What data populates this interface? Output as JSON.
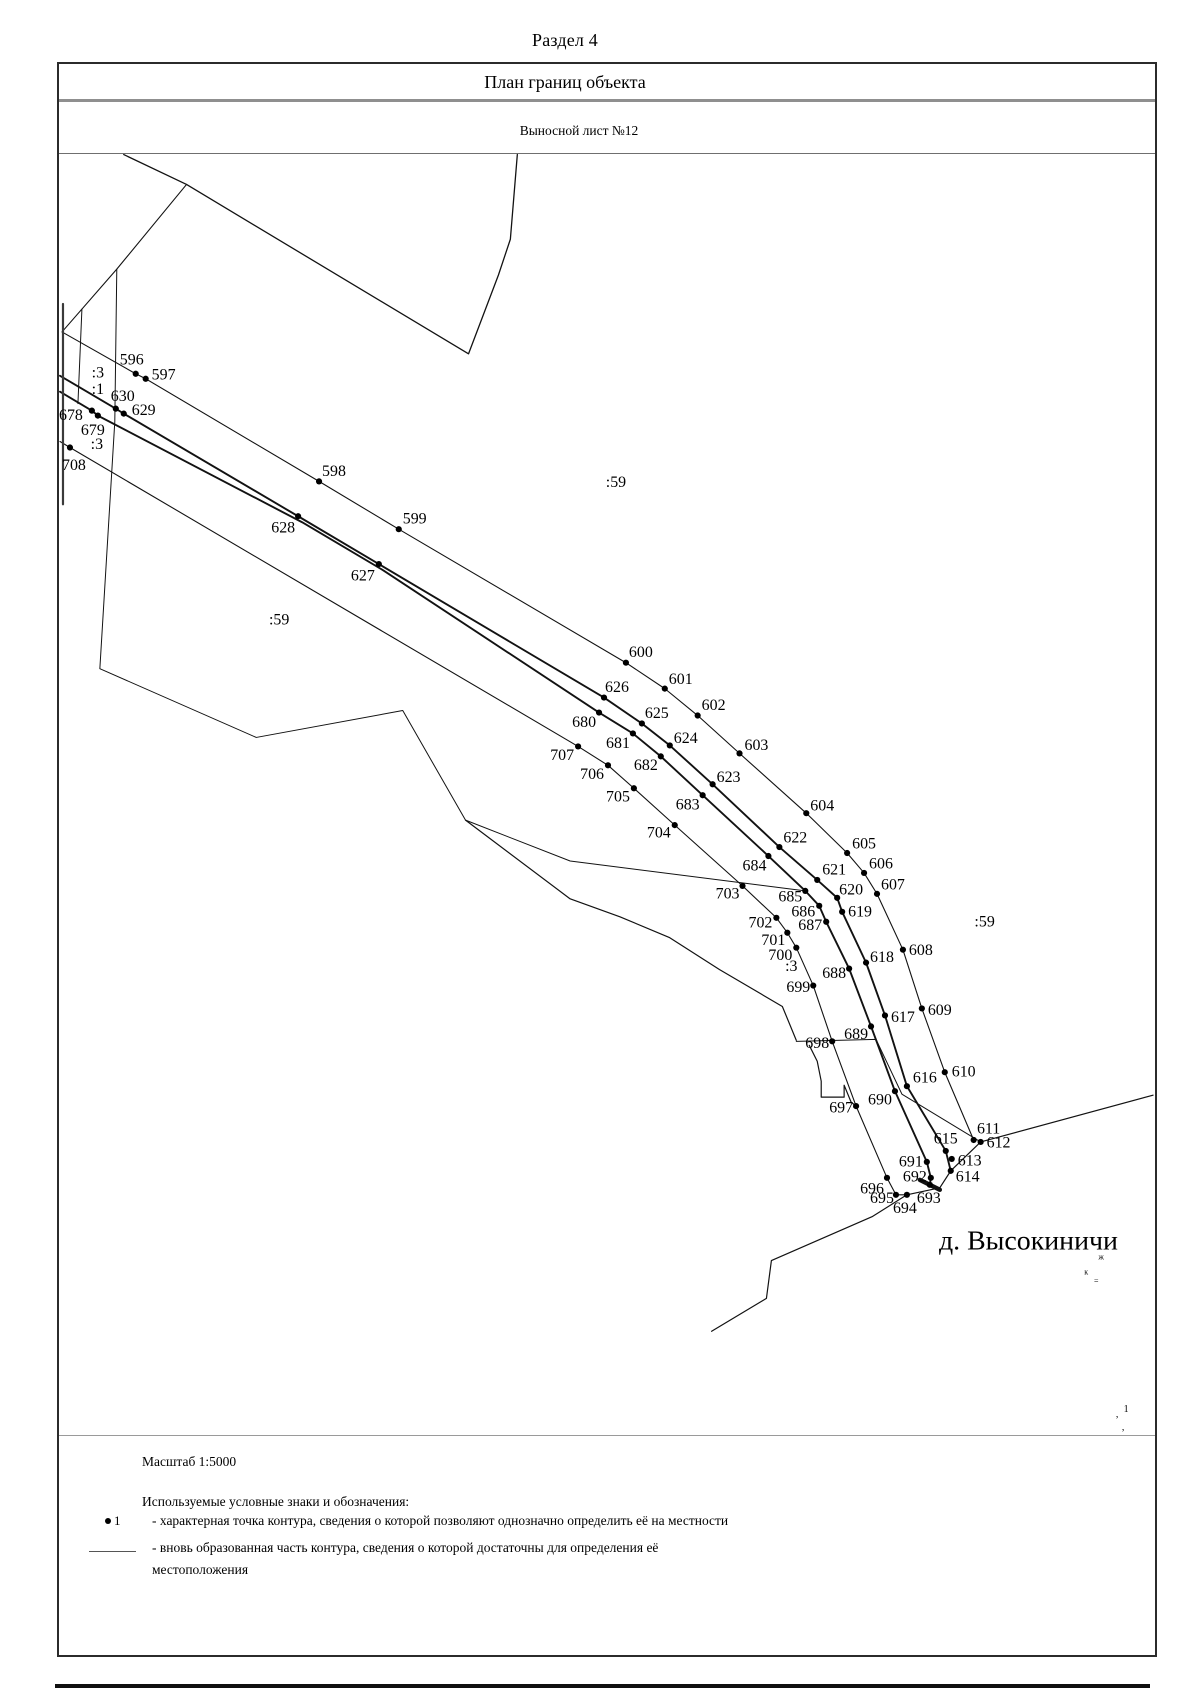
{
  "page": {
    "title": "Раздел 4"
  },
  "panel": {
    "header": "План границ объекта",
    "subheader": "Выносной лист №12"
  },
  "map": {
    "village_label": "д. Высокиничи",
    "parcel_labels": [
      {
        "text": ":3",
        "x": 96,
        "y": 370
      },
      {
        "text": ":1",
        "x": 96,
        "y": 387
      },
      {
        "text": ":3",
        "x": 95,
        "y": 442
      },
      {
        "text": ":59",
        "x": 616,
        "y": 480
      },
      {
        "text": ":59",
        "x": 278,
        "y": 618
      },
      {
        "text": ":59",
        "x": 986,
        "y": 921
      },
      {
        "text": ":3",
        "x": 792,
        "y": 966
      }
    ],
    "points": [
      {
        "n": "596",
        "x": 134,
        "y": 372,
        "lx": 130,
        "ly": 357
      },
      {
        "n": "597",
        "x": 144,
        "y": 377,
        "lx": 162,
        "ly": 372
      },
      {
        "n": "598",
        "x": 318,
        "y": 480,
        "lx": 333,
        "ly": 469
      },
      {
        "n": "599",
        "x": 398,
        "y": 528,
        "lx": 414,
        "ly": 517
      },
      {
        "n": "600",
        "x": 626,
        "y": 662,
        "lx": 641,
        "ly": 651
      },
      {
        "n": "601",
        "x": 665,
        "y": 688,
        "lx": 681,
        "ly": 678
      },
      {
        "n": "602",
        "x": 698,
        "y": 715,
        "lx": 714,
        "ly": 704
      },
      {
        "n": "603",
        "x": 740,
        "y": 753,
        "lx": 757,
        "ly": 744
      },
      {
        "n": "604",
        "x": 807,
        "y": 813,
        "lx": 823,
        "ly": 805
      },
      {
        "n": "605",
        "x": 848,
        "y": 853,
        "lx": 865,
        "ly": 843
      },
      {
        "n": "606",
        "x": 865,
        "y": 873,
        "lx": 882,
        "ly": 863
      },
      {
        "n": "607",
        "x": 878,
        "y": 894,
        "lx": 894,
        "ly": 884
      },
      {
        "n": "608",
        "x": 904,
        "y": 950,
        "lx": 922,
        "ly": 950
      },
      {
        "n": "609",
        "x": 923,
        "y": 1009,
        "lx": 941,
        "ly": 1010
      },
      {
        "n": "610",
        "x": 946,
        "y": 1073,
        "lx": 965,
        "ly": 1072
      },
      {
        "n": "611",
        "x": 975,
        "y": 1141,
        "lx": 990,
        "ly": 1129
      },
      {
        "n": "612",
        "x": 982,
        "y": 1143,
        "lx": 1000,
        "ly": 1143
      },
      {
        "n": "613",
        "x": 953,
        "y": 1160,
        "lx": 971,
        "ly": 1161
      },
      {
        "n": "614",
        "x": 952,
        "y": 1172,
        "lx": 969,
        "ly": 1177
      },
      {
        "n": "615",
        "x": 947,
        "y": 1152,
        "lx": 947,
        "ly": 1139
      },
      {
        "n": "616",
        "x": 908,
        "y": 1087,
        "lx": 926,
        "ly": 1078
      },
      {
        "n": "617",
        "x": 886,
        "y": 1016,
        "lx": 904,
        "ly": 1017
      },
      {
        "n": "618",
        "x": 867,
        "y": 963,
        "lx": 883,
        "ly": 957
      },
      {
        "n": "619",
        "x": 843,
        "y": 912,
        "lx": 861,
        "ly": 911
      },
      {
        "n": "620",
        "x": 838,
        "y": 898,
        "lx": 852,
        "ly": 889
      },
      {
        "n": "621",
        "x": 818,
        "y": 880,
        "lx": 835,
        "ly": 869
      },
      {
        "n": "622",
        "x": 780,
        "y": 847,
        "lx": 796,
        "ly": 837
      },
      {
        "n": "623",
        "x": 713,
        "y": 784,
        "lx": 729,
        "ly": 776
      },
      {
        "n": "624",
        "x": 670,
        "y": 745,
        "lx": 686,
        "ly": 737
      },
      {
        "n": "625",
        "x": 642,
        "y": 723,
        "lx": 657,
        "ly": 712
      },
      {
        "n": "626",
        "x": 604,
        "y": 697,
        "lx": 617,
        "ly": 686
      },
      {
        "n": "627",
        "x": 378,
        "y": 563,
        "lx": 362,
        "ly": 574
      },
      {
        "n": "628",
        "x": 297,
        "y": 515,
        "lx": 282,
        "ly": 526
      },
      {
        "n": "629",
        "x": 122,
        "y": 412,
        "lx": 142,
        "ly": 408
      },
      {
        "n": "630",
        "x": 114,
        "y": 407,
        "lx": 121,
        "ly": 394
      },
      {
        "n": "678",
        "x": 90,
        "y": 409,
        "lx": 69,
        "ly": 413
      },
      {
        "n": "679",
        "x": 96,
        "y": 414,
        "lx": 91,
        "ly": 428
      },
      {
        "n": "680",
        "x": 599,
        "y": 712,
        "lx": 584,
        "ly": 721
      },
      {
        "n": "681",
        "x": 633,
        "y": 733,
        "lx": 618,
        "ly": 742
      },
      {
        "n": "682",
        "x": 661,
        "y": 756,
        "lx": 646,
        "ly": 764
      },
      {
        "n": "683",
        "x": 703,
        "y": 795,
        "lx": 688,
        "ly": 804
      },
      {
        "n": "684",
        "x": 769,
        "y": 856,
        "lx": 755,
        "ly": 865
      },
      {
        "n": "685",
        "x": 806,
        "y": 891,
        "lx": 791,
        "ly": 896
      },
      {
        "n": "686",
        "x": 820,
        "y": 906,
        "lx": 804,
        "ly": 911
      },
      {
        "n": "687",
        "x": 827,
        "y": 922,
        "lx": 811,
        "ly": 925
      },
      {
        "n": "688",
        "x": 850,
        "y": 969,
        "lx": 835,
        "ly": 973
      },
      {
        "n": "689",
        "x": 872,
        "y": 1027,
        "lx": 857,
        "ly": 1034
      },
      {
        "n": "690",
        "x": 896,
        "y": 1092,
        "lx": 881,
        "ly": 1100
      },
      {
        "n": "691",
        "x": 928,
        "y": 1163,
        "lx": 912,
        "ly": 1162
      },
      {
        "n": "692",
        "x": 932,
        "y": 1179,
        "lx": 916,
        "ly": 1177
      },
      {
        "n": "693",
        "x": 931,
        "y": 1186,
        "lx": 930,
        "ly": 1199
      },
      {
        "n": "694",
        "x": 908,
        "y": 1196,
        "lx": 906,
        "ly": 1209
      },
      {
        "n": "695",
        "x": 897,
        "y": 1196,
        "lx": 883,
        "ly": 1199
      },
      {
        "n": "696",
        "x": 888,
        "y": 1179,
        "lx": 873,
        "ly": 1189
      },
      {
        "n": "697",
        "x": 857,
        "y": 1107,
        "lx": 842,
        "ly": 1108
      },
      {
        "n": "698",
        "x": 833,
        "y": 1042,
        "lx": 818,
        "ly": 1043
      },
      {
        "n": "699",
        "x": 814,
        "y": 986,
        "lx": 799,
        "ly": 987
      },
      {
        "n": "700",
        "x": 797,
        "y": 948,
        "lx": 781,
        "ly": 955
      },
      {
        "n": "701",
        "x": 788,
        "y": 933,
        "lx": 774,
        "ly": 940
      },
      {
        "n": "702",
        "x": 777,
        "y": 918,
        "lx": 761,
        "ly": 922
      },
      {
        "n": "703",
        "x": 743,
        "y": 886,
        "lx": 728,
        "ly": 893
      },
      {
        "n": "704",
        "x": 675,
        "y": 825,
        "lx": 659,
        "ly": 832
      },
      {
        "n": "705",
        "x": 634,
        "y": 788,
        "lx": 618,
        "ly": 796
      },
      {
        "n": "706",
        "x": 608,
        "y": 765,
        "lx": 592,
        "ly": 773
      },
      {
        "n": "707",
        "x": 578,
        "y": 746,
        "lx": 562,
        "ly": 754
      },
      {
        "n": "708",
        "x": 68,
        "y": 446,
        "lx": 72,
        "ly": 463
      }
    ],
    "lines": [
      {
        "id": "north-boundary",
        "w": 1.1,
        "pts": [
          [
            185,
            182
          ],
          [
            115,
            267
          ],
          [
            60,
            330
          ],
          [
            134,
            372
          ],
          [
            144,
            377
          ],
          [
            318,
            480
          ],
          [
            398,
            528
          ],
          [
            626,
            662
          ],
          [
            665,
            688
          ],
          [
            698,
            715
          ],
          [
            740,
            753
          ],
          [
            807,
            813
          ],
          [
            848,
            853
          ],
          [
            865,
            873
          ],
          [
            878,
            894
          ],
          [
            904,
            950
          ],
          [
            923,
            1009
          ],
          [
            946,
            1073
          ],
          [
            975,
            1141
          ]
        ]
      },
      {
        "id": "road-edge-upper",
        "w": 1.9,
        "pts": [
          [
            58,
            374
          ],
          [
            114,
            407
          ],
          [
            122,
            412
          ],
          [
            297,
            515
          ],
          [
            378,
            563
          ],
          [
            604,
            697
          ],
          [
            642,
            723
          ],
          [
            670,
            745
          ],
          [
            713,
            784
          ],
          [
            780,
            847
          ],
          [
            818,
            880
          ],
          [
            838,
            898
          ],
          [
            843,
            912
          ],
          [
            867,
            963
          ],
          [
            886,
            1016
          ],
          [
            908,
            1087
          ],
          [
            947,
            1152
          ],
          [
            952,
            1172
          ]
        ]
      },
      {
        "id": "road-edge-lower",
        "w": 1.9,
        "pts": [
          [
            58,
            390
          ],
          [
            90,
            409
          ],
          [
            96,
            414
          ],
          [
            301,
            521
          ],
          [
            382,
            569
          ],
          [
            599,
            712
          ],
          [
            633,
            733
          ],
          [
            661,
            756
          ],
          [
            703,
            795
          ],
          [
            769,
            856
          ],
          [
            806,
            891
          ],
          [
            820,
            906
          ],
          [
            827,
            922
          ],
          [
            850,
            969
          ],
          [
            872,
            1027
          ],
          [
            896,
            1092
          ],
          [
            928,
            1163
          ],
          [
            932,
            1179
          ],
          [
            931,
            1186
          ]
        ]
      },
      {
        "id": "south-boundary",
        "w": 1.1,
        "pts": [
          [
            58,
            440
          ],
          [
            68,
            446
          ],
          [
            578,
            746
          ],
          [
            608,
            765
          ],
          [
            634,
            788
          ],
          [
            675,
            825
          ],
          [
            743,
            886
          ],
          [
            777,
            918
          ],
          [
            788,
            933
          ],
          [
            797,
            948
          ],
          [
            814,
            986
          ],
          [
            833,
            1042
          ],
          [
            857,
            1107
          ],
          [
            888,
            1179
          ],
          [
            897,
            1196
          ],
          [
            908,
            1196
          ]
        ]
      },
      {
        "id": "village-boundary",
        "w": 1.2,
        "pts": [
          [
            1155,
            1096
          ],
          [
            982,
            1143
          ],
          [
            952,
            1172
          ],
          [
            941,
            1189
          ],
          [
            908,
            1196
          ],
          [
            873,
            1218
          ],
          [
            772,
            1262
          ],
          [
            767,
            1300
          ],
          [
            712,
            1333
          ]
        ]
      },
      {
        "id": "field-polygon",
        "w": 1.3,
        "pts": [
          [
            122,
            152
          ],
          [
            185,
            182
          ],
          [
            468,
            352
          ],
          [
            498,
            273
          ],
          [
            510,
            237
          ],
          [
            517,
            152
          ]
        ]
      },
      {
        "id": "left-vertical-a",
        "w": 1,
        "pts": [
          [
            80,
            307
          ],
          [
            76,
            402
          ]
        ]
      },
      {
        "id": "left-vertical-b",
        "w": 1,
        "pts": [
          [
            115,
            267
          ],
          [
            113,
            420
          ],
          [
            98,
            668
          ],
          [
            255,
            737
          ],
          [
            402,
            710
          ],
          [
            465,
            820
          ],
          [
            570,
            861
          ],
          [
            806,
            891
          ]
        ]
      },
      {
        "id": "left-vertical-c",
        "w": 2.2,
        "color": "#3a3a3a",
        "pts": [
          [
            61,
            302
          ],
          [
            61,
            503
          ]
        ]
      },
      {
        "id": "settlement-west",
        "w": 1.2,
        "pts": [
          [
            465,
            820
          ],
          [
            570,
            899
          ],
          [
            620,
            917
          ],
          [
            670,
            938
          ],
          [
            720,
            970
          ],
          [
            783,
            1007
          ],
          [
            797,
            1041
          ]
        ]
      },
      {
        "id": "settlement-east",
        "w": 1,
        "pts": [
          [
            797,
            1042
          ],
          [
            877,
            1040
          ],
          [
            903,
            1095
          ],
          [
            982,
            1143
          ]
        ]
      },
      {
        "id": "notch-zigzag",
        "w": 1.2,
        "pts": [
          [
            810,
            1046
          ],
          [
            818,
            1062
          ],
          [
            822,
            1082
          ],
          [
            822,
            1098
          ],
          [
            845,
            1098
          ],
          [
            845,
            1086
          ],
          [
            852,
            1103
          ],
          [
            857,
            1107
          ]
        ]
      },
      {
        "id": "bold-segment",
        "w": 4.5,
        "pts": [
          [
            921,
            1181
          ],
          [
            941,
            1191
          ]
        ]
      }
    ],
    "tiny_marks": [
      {
        "t": "ж",
        "x": 1103,
        "y": 1261,
        "s": 8
      },
      {
        "t": "к",
        "x": 1088,
        "y": 1276,
        "s": 8
      },
      {
        "t": "=",
        "x": 1098,
        "y": 1285,
        "s": 8
      },
      {
        "t": "1",
        "x": 1128,
        "y": 1414,
        "s": 10
      },
      {
        "t": ",",
        "x": 1119,
        "y": 1419,
        "s": 10
      },
      {
        "t": ",",
        "x": 1125,
        "y": 1432,
        "s": 10
      }
    ]
  },
  "legend": {
    "scale": "Масштаб 1:5000",
    "symbols_title": "Используемые условные знаки и обозначения:",
    "items": [
      {
        "marker_label": "1",
        "text": "- характерная точка контура, сведения о которой позволяют однозначно определить её на местности"
      },
      {
        "text": "- вновь образованная часть контура, сведения о которой достаточны для определения её местоположения"
      }
    ]
  }
}
